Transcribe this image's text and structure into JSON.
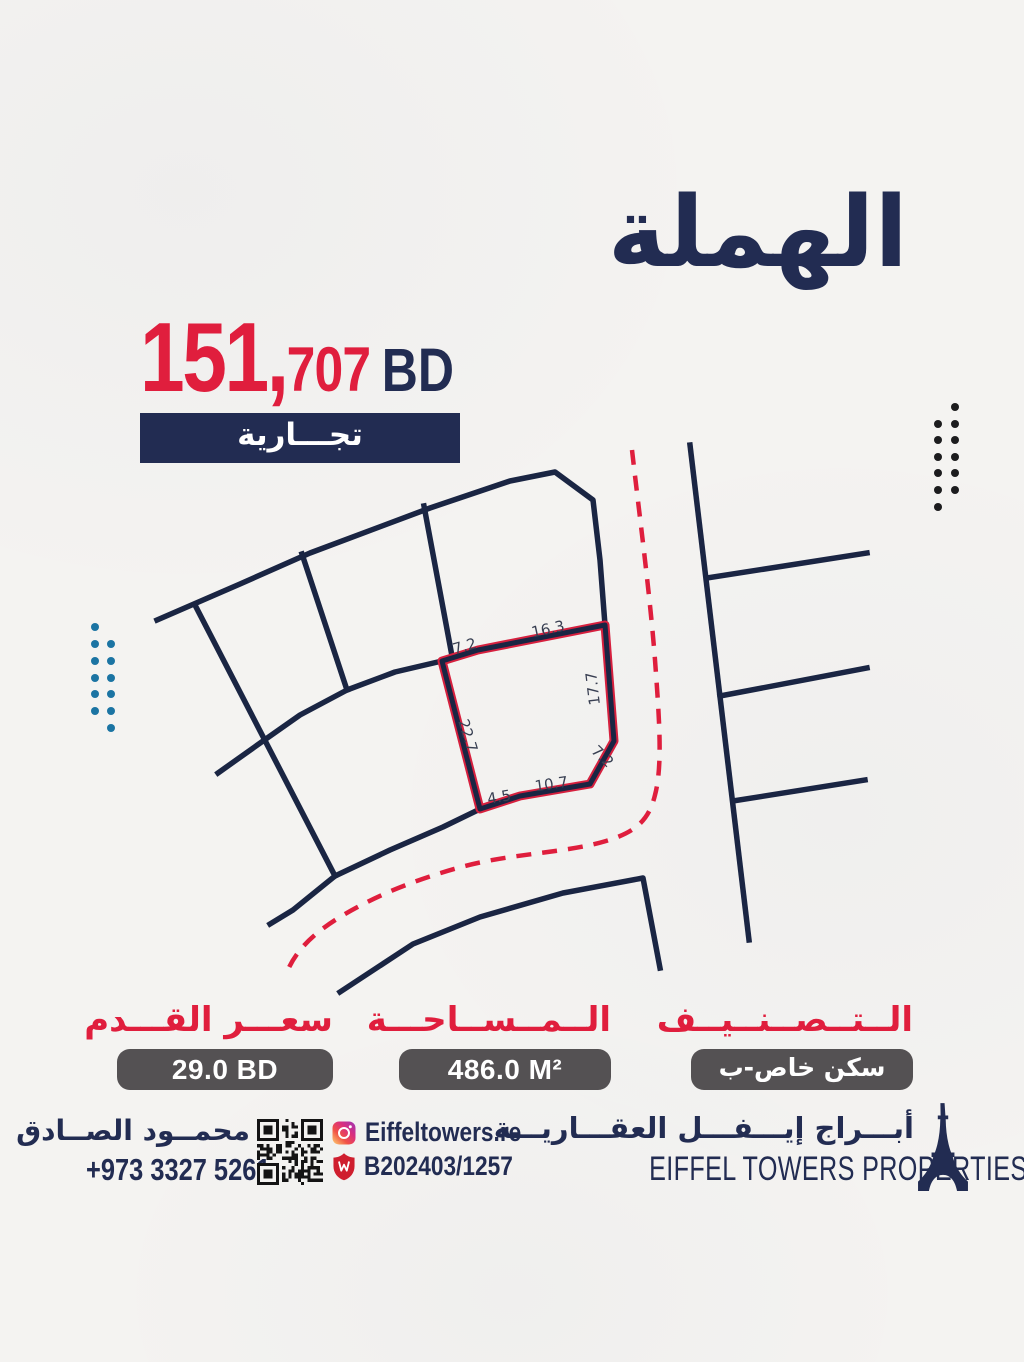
{
  "title": "الهملة",
  "price": {
    "main": "151,",
    "sub": "707",
    "currency": "BD"
  },
  "badge_label": "تجـــارية",
  "map": {
    "plot_dimensions": {
      "top_left": "7.2",
      "top": "16.3",
      "right": "17.7",
      "corner": "7.2",
      "bottom": "10.7",
      "bottom_left": "4.5",
      "left": "22.7"
    }
  },
  "details": {
    "price_per_foot": {
      "label": "سعـــر القـــدم",
      "value": "29.0 BD"
    },
    "area": {
      "label": "الــمــســاحـــة",
      "value": "486.0 M²"
    },
    "classification": {
      "label": "الــتــصــنــيــف",
      "value": "سكن خاص-ب"
    }
  },
  "footer": {
    "agent_name": "محمــود الصــادق",
    "phone": "+973 3327 5261",
    "instagram": "Eiffeltowers.re",
    "license": "B202403/1257",
    "company_ar": "أبـــراج إيـــفـــل العقـــاريـــة",
    "company_en": "EIFFEL TOWERS PROPERTIES"
  },
  "colors": {
    "navy": "#222c52",
    "line": "#1a2543",
    "red": "#e01e3d",
    "teal": "#1b74a3",
    "dot": "#1c1c1e",
    "box": "#545153",
    "paper": "#f4f3f1"
  }
}
